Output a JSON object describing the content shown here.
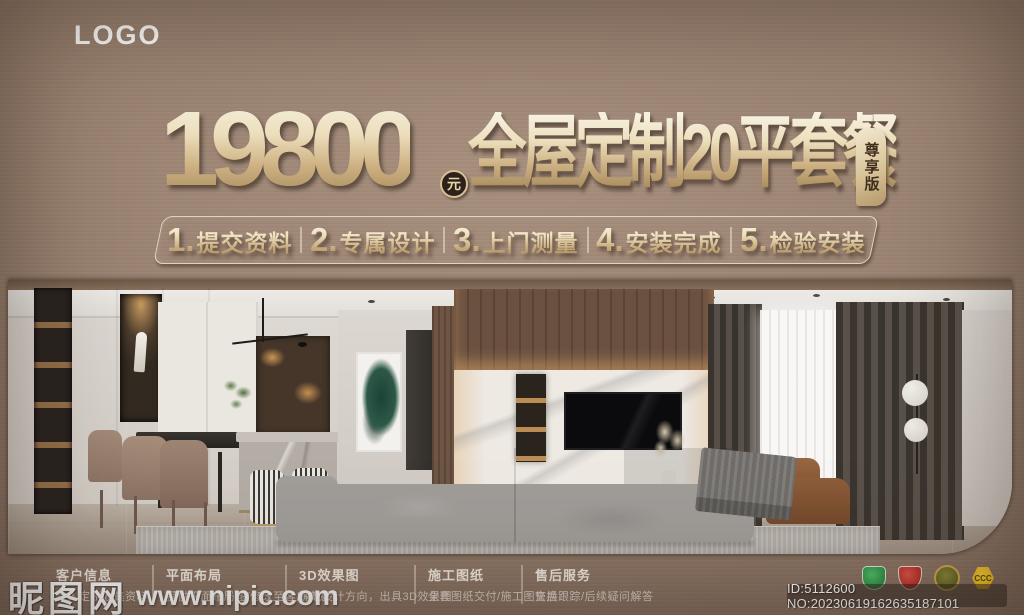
{
  "header": {
    "logo": "LOGO"
  },
  "hero": {
    "price": "19800",
    "unit": "元",
    "title": "全屋定制20平套餐",
    "badge": "尊享版"
  },
  "steps": {
    "items": [
      {
        "num": "1.",
        "label": "提交资料"
      },
      {
        "num": "2.",
        "label": "专属设计"
      },
      {
        "num": "3.",
        "label": "上门测量"
      },
      {
        "num": "4.",
        "label": "安装完成"
      },
      {
        "num": "5.",
        "label": "检验安装"
      }
    ]
  },
  "footer": {
    "columns": [
      {
        "title": "客户信息",
        "desc": "私人定制收集资料"
      },
      {
        "title": "平面布局",
        "desc": "提供平面布局图/修改至客户满意"
      },
      {
        "title": "3D效果图",
        "desc": "确定设计方向，出具3D效果图"
      },
      {
        "title": "施工图纸",
        "desc": "全套图纸交付/施工图交换"
      },
      {
        "title": "售后服务",
        "desc": "售后跟踪/后续疑问解答"
      }
    ],
    "cert_icons": [
      {
        "name": "green-quality-badge",
        "color": "#2f9e4f",
        "label": ""
      },
      {
        "name": "red-shield-badge",
        "color": "#c2312c",
        "label": ""
      },
      {
        "name": "gold-medal-badge",
        "color": "#77741f",
        "label": ""
      },
      {
        "name": "ccc-cert-badge",
        "color": "#f3c21c",
        "label": "CCC"
      }
    ],
    "id_text": "ID:5112600 NO:20230619162635187101"
  },
  "watermark": {
    "site": "昵图网",
    "url": "www.nipic.com"
  },
  "colors": {
    "bronze": "#97806f",
    "gold_light": "#faf4e3",
    "gold_dark": "#a98c5c",
    "footer_text": "#f0e9e1"
  }
}
